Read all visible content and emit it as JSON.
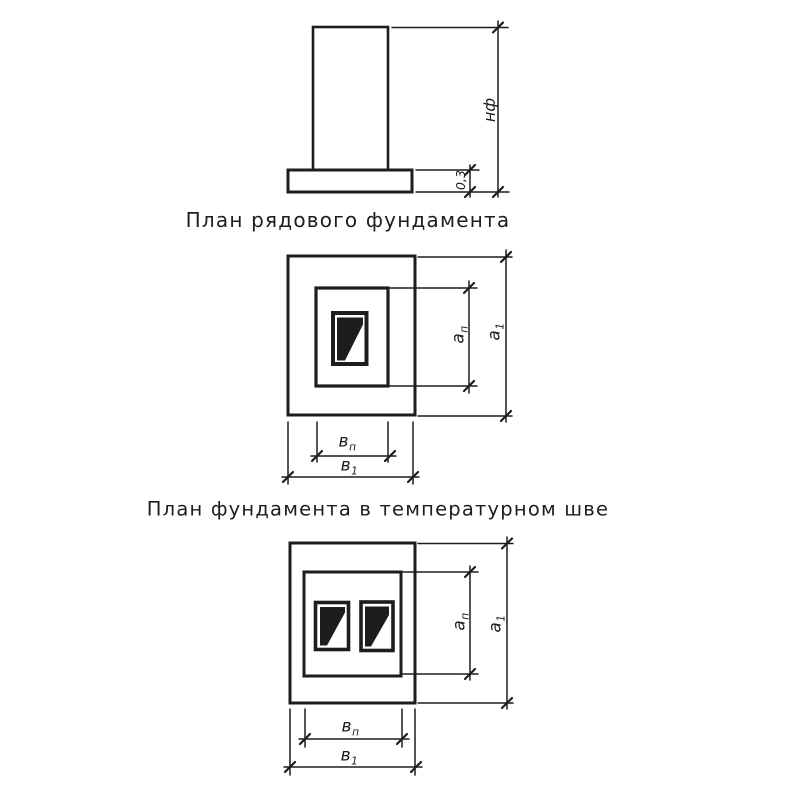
{
  "titles": {
    "regular_plan": "План рядового фундамента",
    "expansion_plan": "План фундамента в температурном шве"
  },
  "elevation_dims": {
    "foundation_height": "нф",
    "slab_thickness": "0,3"
  },
  "plan_dims": {
    "a_p": {
      "base": "а",
      "sub": "п"
    },
    "a_1": {
      "base": "а",
      "sub": "1"
    },
    "b_p": {
      "base": "в",
      "sub": "п"
    },
    "b_1": {
      "base": "в",
      "sub": "1"
    }
  },
  "colors": {
    "ink": "#1d1d1d",
    "paper": "#ffffff"
  }
}
